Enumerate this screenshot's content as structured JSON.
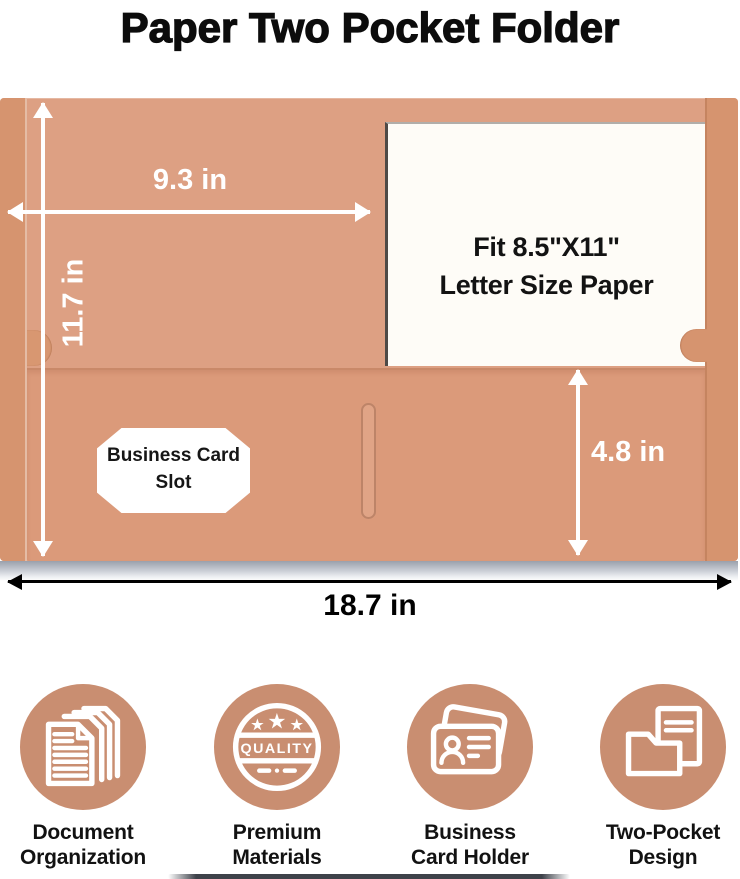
{
  "title": "Paper Two Pocket Folder",
  "colors": {
    "folder_body": "#dda083",
    "folder_edge": "#d6946f",
    "pocket": "#db9a7a",
    "icon_circle": "#c98e71",
    "dimension_text": "#ffffff",
    "bottom_dimension_text": "#000000"
  },
  "dimensions": {
    "width_top": "9.3 in",
    "height_left": "11.7 in",
    "pocket_height": "4.8 in",
    "width_bottom": "18.7 in"
  },
  "paper_insert": {
    "line1": "Fit 8.5\"X11\"",
    "line2": "Letter Size Paper"
  },
  "card_slot": {
    "line1": "Business Card",
    "line2": "Slot"
  },
  "features": [
    {
      "line1": "Document",
      "line2": "Organization",
      "icon": "stacked-documents-icon"
    },
    {
      "line1": "Premium",
      "line2": "Materials",
      "icon": "quality-badge-icon",
      "badge_text": "QUALITY"
    },
    {
      "line1": "Business",
      "line2": "Card Holder",
      "icon": "business-card-icon"
    },
    {
      "line1": "Two-Pocket",
      "line2": "Design",
      "icon": "two-pocket-folder-icon"
    }
  ]
}
